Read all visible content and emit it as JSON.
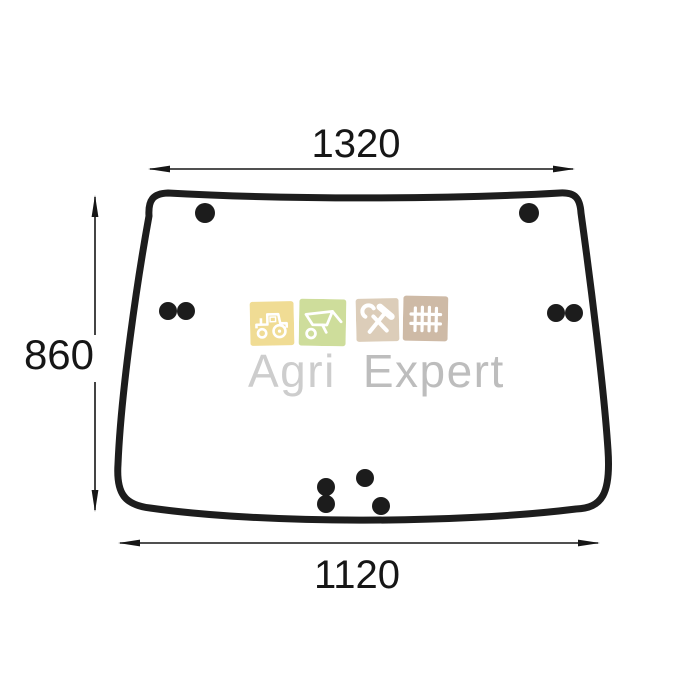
{
  "drawing": {
    "subject": "tractor-cab-glass-technical-diagram",
    "line_color": "#1d1d1d",
    "dimensions": {
      "top_width": "1320",
      "side_height": "860",
      "bottom_width": "1120"
    },
    "mounting_holes_count": "10"
  },
  "watermark": {
    "brand_first": "Agri",
    "brand_second": "Expert",
    "text_color_first": "#cdcdcd",
    "text_color_second": "#bdbdbd",
    "icons": [
      {
        "name": "tractor-icon",
        "bg": "#efda8c"
      },
      {
        "name": "wheelbarrow-icon",
        "bg": "#cbdb94"
      },
      {
        "name": "hammer-wrench-icon",
        "bg": "#dacab4"
      },
      {
        "name": "fence-icon",
        "bg": "#cbb5a0"
      }
    ]
  }
}
